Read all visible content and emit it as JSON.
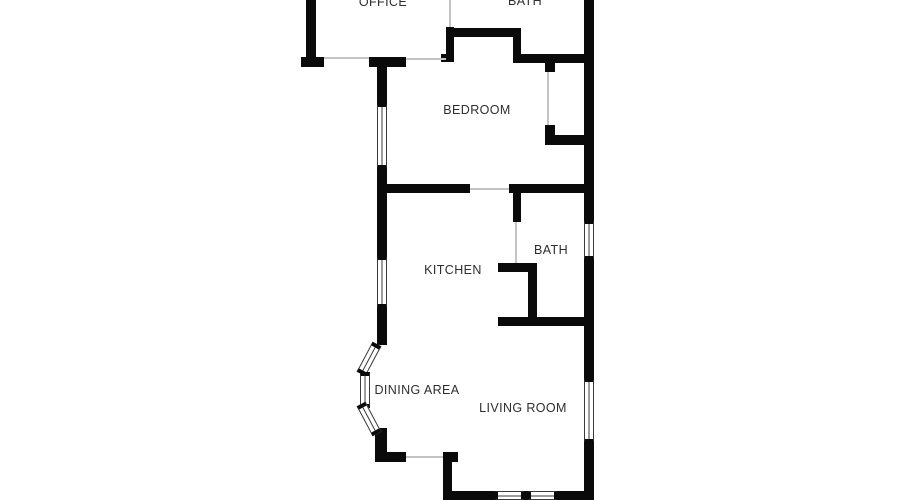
{
  "page": {
    "background_color": "#ffffff"
  },
  "floorplan": {
    "wall_color": "#0a0a0a",
    "door_line_color": "#c4c4c4",
    "text_color": "#2e2e2e",
    "rooms": [
      {
        "id": "office",
        "label": "OFFICE"
      },
      {
        "id": "bath-top",
        "label": "BATH"
      },
      {
        "id": "bedroom",
        "label": "BEDROOM"
      },
      {
        "id": "kitchen",
        "label": "KITCHEN"
      },
      {
        "id": "bath-middle",
        "label": "BATH"
      },
      {
        "id": "dining-area",
        "label": "DINING AREA"
      },
      {
        "id": "living-room",
        "label": "LIVING ROOM"
      }
    ]
  }
}
